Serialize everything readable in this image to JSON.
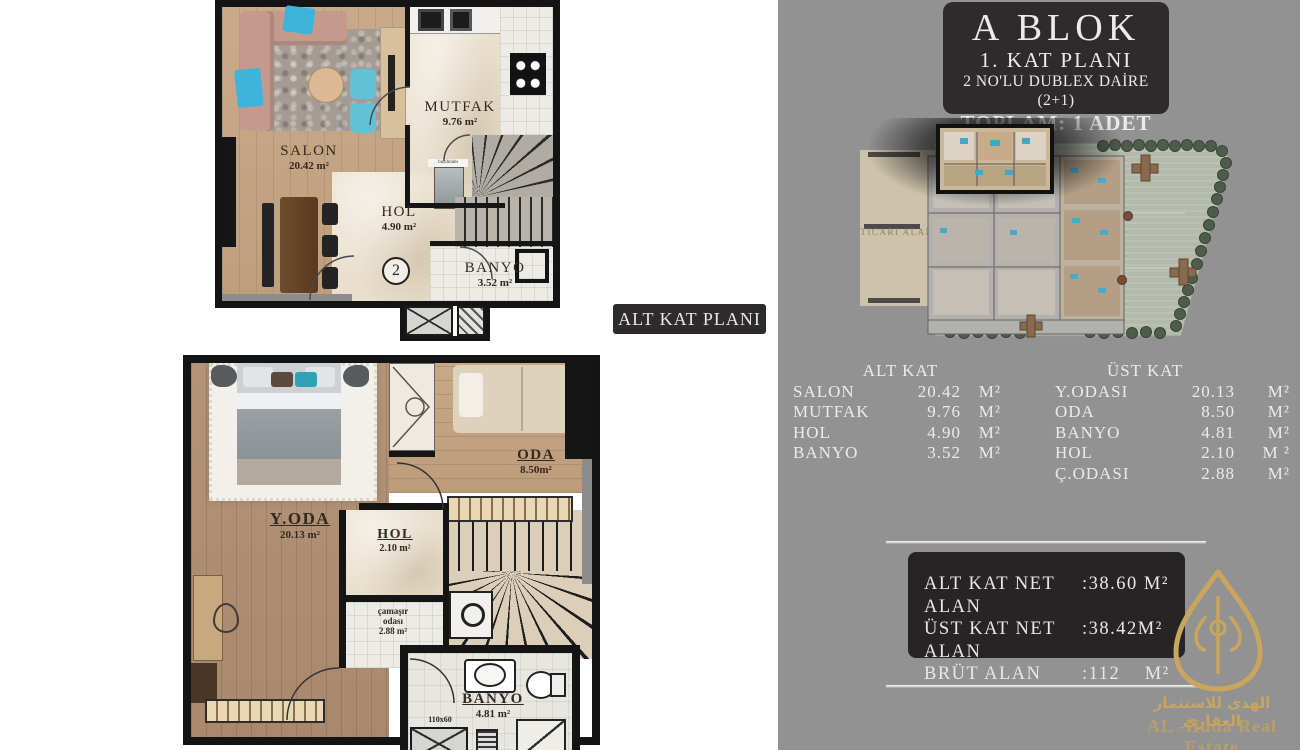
{
  "title_block": {
    "line1": "A BLOK",
    "line2": "1. KAT PLANI",
    "line3": "2 NO'LU DUBLEX DAİRE (2+1)",
    "line4": "TOPLAM: 1 ADET"
  },
  "plan_tag": "ALT KAT PLANI",
  "site_plan": {
    "ticari_alan_label": "TICARI ALAN"
  },
  "upper_plan": {
    "rooms": {
      "salon": {
        "name": "SALON",
        "area": "20.42 m²"
      },
      "mutfak": {
        "name": "MUTFAK",
        "area": "9.76 m²"
      },
      "hol": {
        "name": "HOL",
        "area": "4.90 m²"
      },
      "banyo": {
        "name": "BANYO",
        "area": "3.52 m²"
      }
    },
    "unit_number": "2",
    "appliance_label": "buzdolabı"
  },
  "lower_plan": {
    "rooms": {
      "y_oda": {
        "name": "Y.ODA",
        "area": "20.13 m²"
      },
      "oda": {
        "name": "ODA",
        "area": "8.50m²"
      },
      "hol": {
        "name": "HOL",
        "area": "2.10 m²"
      },
      "camasir": {
        "name_line1": "çamaşır",
        "name_line2": "odası",
        "area": "2.88 m²"
      },
      "banyo": {
        "name": "BANYO",
        "area": "4.81 m²"
      }
    },
    "shower_size_label": "110x60"
  },
  "tables": {
    "alt_kat": {
      "header": "ALT KAT",
      "rows": [
        {
          "name": "SALON",
          "value": "20.42",
          "unit": "M²"
        },
        {
          "name": "MUTFAK",
          "value": "9.76",
          "unit": "M²"
        },
        {
          "name": "HOL",
          "value": "4.90",
          "unit": "M²"
        },
        {
          "name": "BANYO",
          "value": "3.52",
          "unit": "M²"
        }
      ]
    },
    "ust_kat": {
      "header": "ÜST KAT",
      "rows": [
        {
          "name": "Y.ODASI",
          "value": "20.13",
          "unit": "M²"
        },
        {
          "name": "ODA",
          "value": "8.50",
          "unit": "M²"
        },
        {
          "name": "BANYO",
          "value": "4.81",
          "unit": "M²"
        },
        {
          "name": "HOL",
          "value": "2.10",
          "unit": "M ²"
        },
        {
          "name": "Ç.ODASI",
          "value": "2.88",
          "unit": "M²"
        }
      ]
    }
  },
  "net_box": {
    "rows": [
      {
        "label": "ALT KAT NET ALAN",
        "value": ":38.60 M²"
      },
      {
        "label": "ÜST KAT NET ALAN",
        "value": ":38.42M²"
      },
      {
        "label": "BRÜT ALAN",
        "value": ":112    M²"
      }
    ]
  },
  "logo": {
    "arabic": "الهدى للاستثمار العقاري",
    "english": "AL -Huda Real Estate"
  },
  "colors": {
    "panel_gray": "#929292",
    "dark_box": "#2d2b2c",
    "gold": "#c9a55e",
    "accent_blue": "#3fb3dc"
  }
}
